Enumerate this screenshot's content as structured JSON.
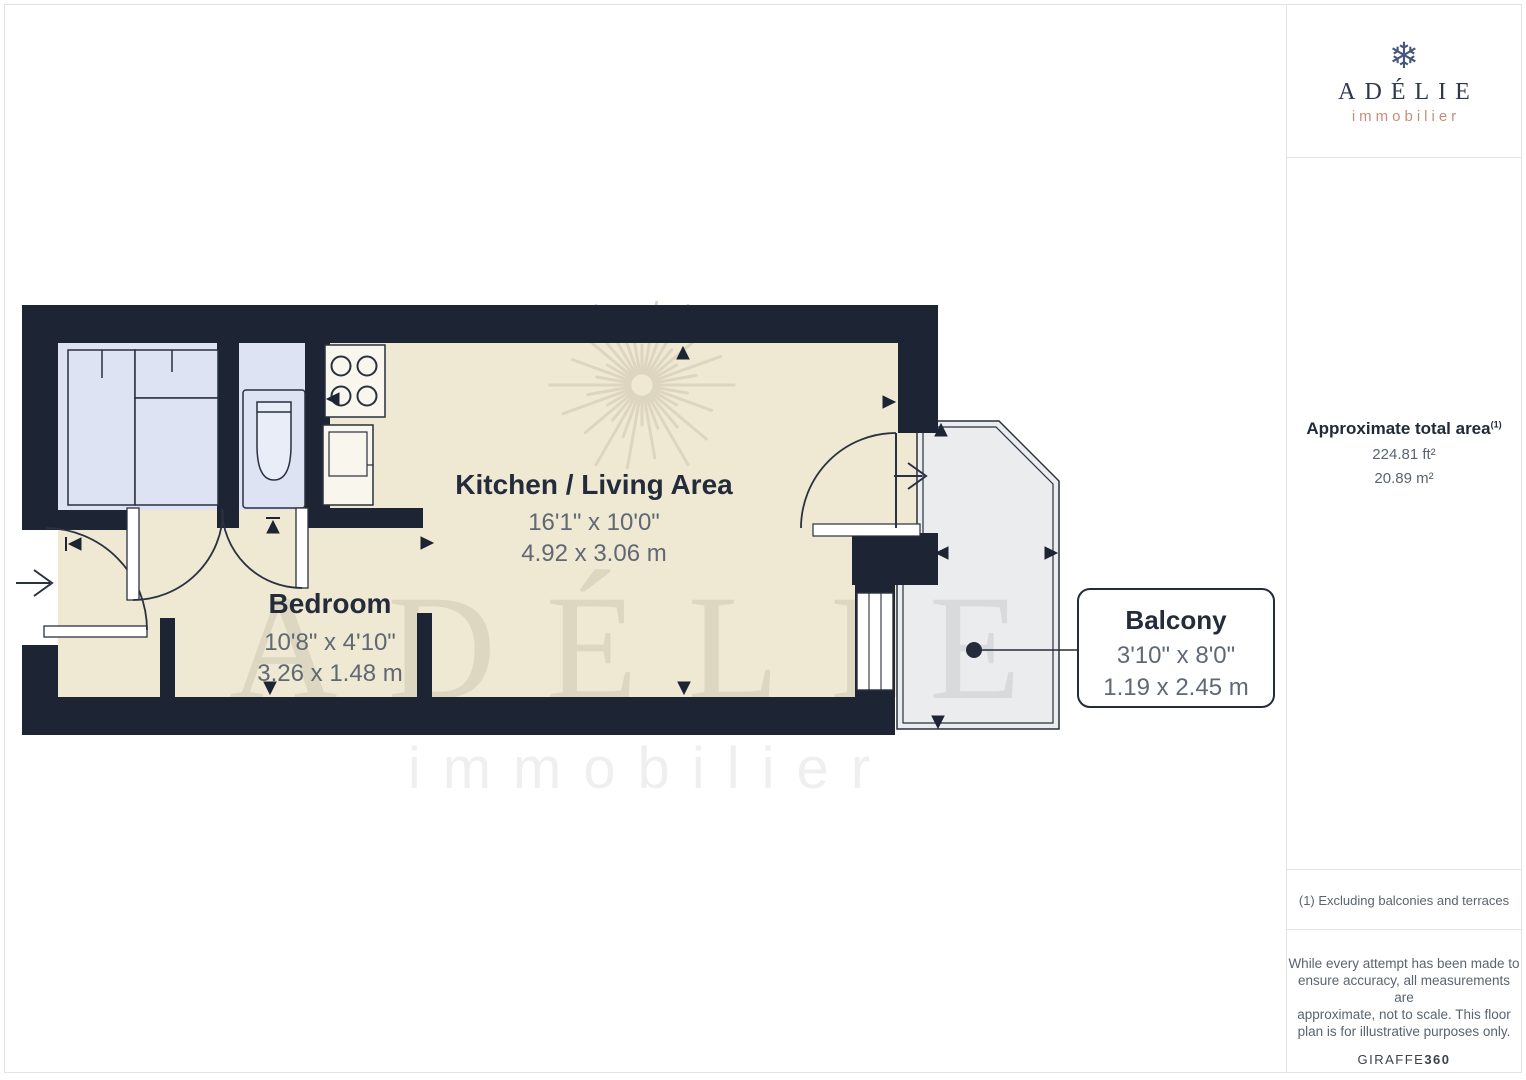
{
  "floor_plan": {
    "rooms": [
      {
        "id": "kitchen-living",
        "name": "Kitchen / Living Area",
        "dimensions_imperial": "16'1\" x 10'0\"",
        "dimensions_metric": "4.92 x 3.06 m"
      },
      {
        "id": "bedroom",
        "name": "Bedroom",
        "dimensions_imperial": "10'8\" x 4'10\"",
        "dimensions_metric": "3.26 x 1.48 m"
      },
      {
        "id": "balcony",
        "name": "Balcony",
        "dimensions_imperial": "3'10\" x 8'0\"",
        "dimensions_metric": "1.19 x 2.45 m"
      }
    ],
    "watermark": {
      "brand": "ADÉLIE",
      "subtitle": "immobilier",
      "icon": "starburst-snowflake-icon"
    }
  },
  "sidebar": {
    "logo": {
      "brand": "ADÉLIE",
      "subtitle": "immobilier",
      "icon": "snowflake-icon"
    },
    "total_area": {
      "title": "Approximate total area",
      "footnote_marker": "(1)",
      "imperial": "224.81 ft²",
      "metric": "20.89 m²"
    },
    "footnote": "(1) Excluding balconies and terraces",
    "disclaimer_lines": [
      "While every attempt has been made to",
      "ensure accuracy, all measurements are",
      "approximate, not to scale. This floor",
      "plan is for illustrative purposes only."
    ],
    "provider": {
      "name": "GIRAFFE",
      "suffix": "360"
    }
  },
  "colors": {
    "wall": "#1d2433",
    "floor": "#efe8d3",
    "fixture": "#dde3f3",
    "balcony_floor": "#ebecee",
    "watermark": "#ded5c0",
    "logo_navy": "#2d3850",
    "logo_salmon": "#c88e79",
    "label_dark": "#242c3b",
    "label_gray": "#5f6873"
  }
}
